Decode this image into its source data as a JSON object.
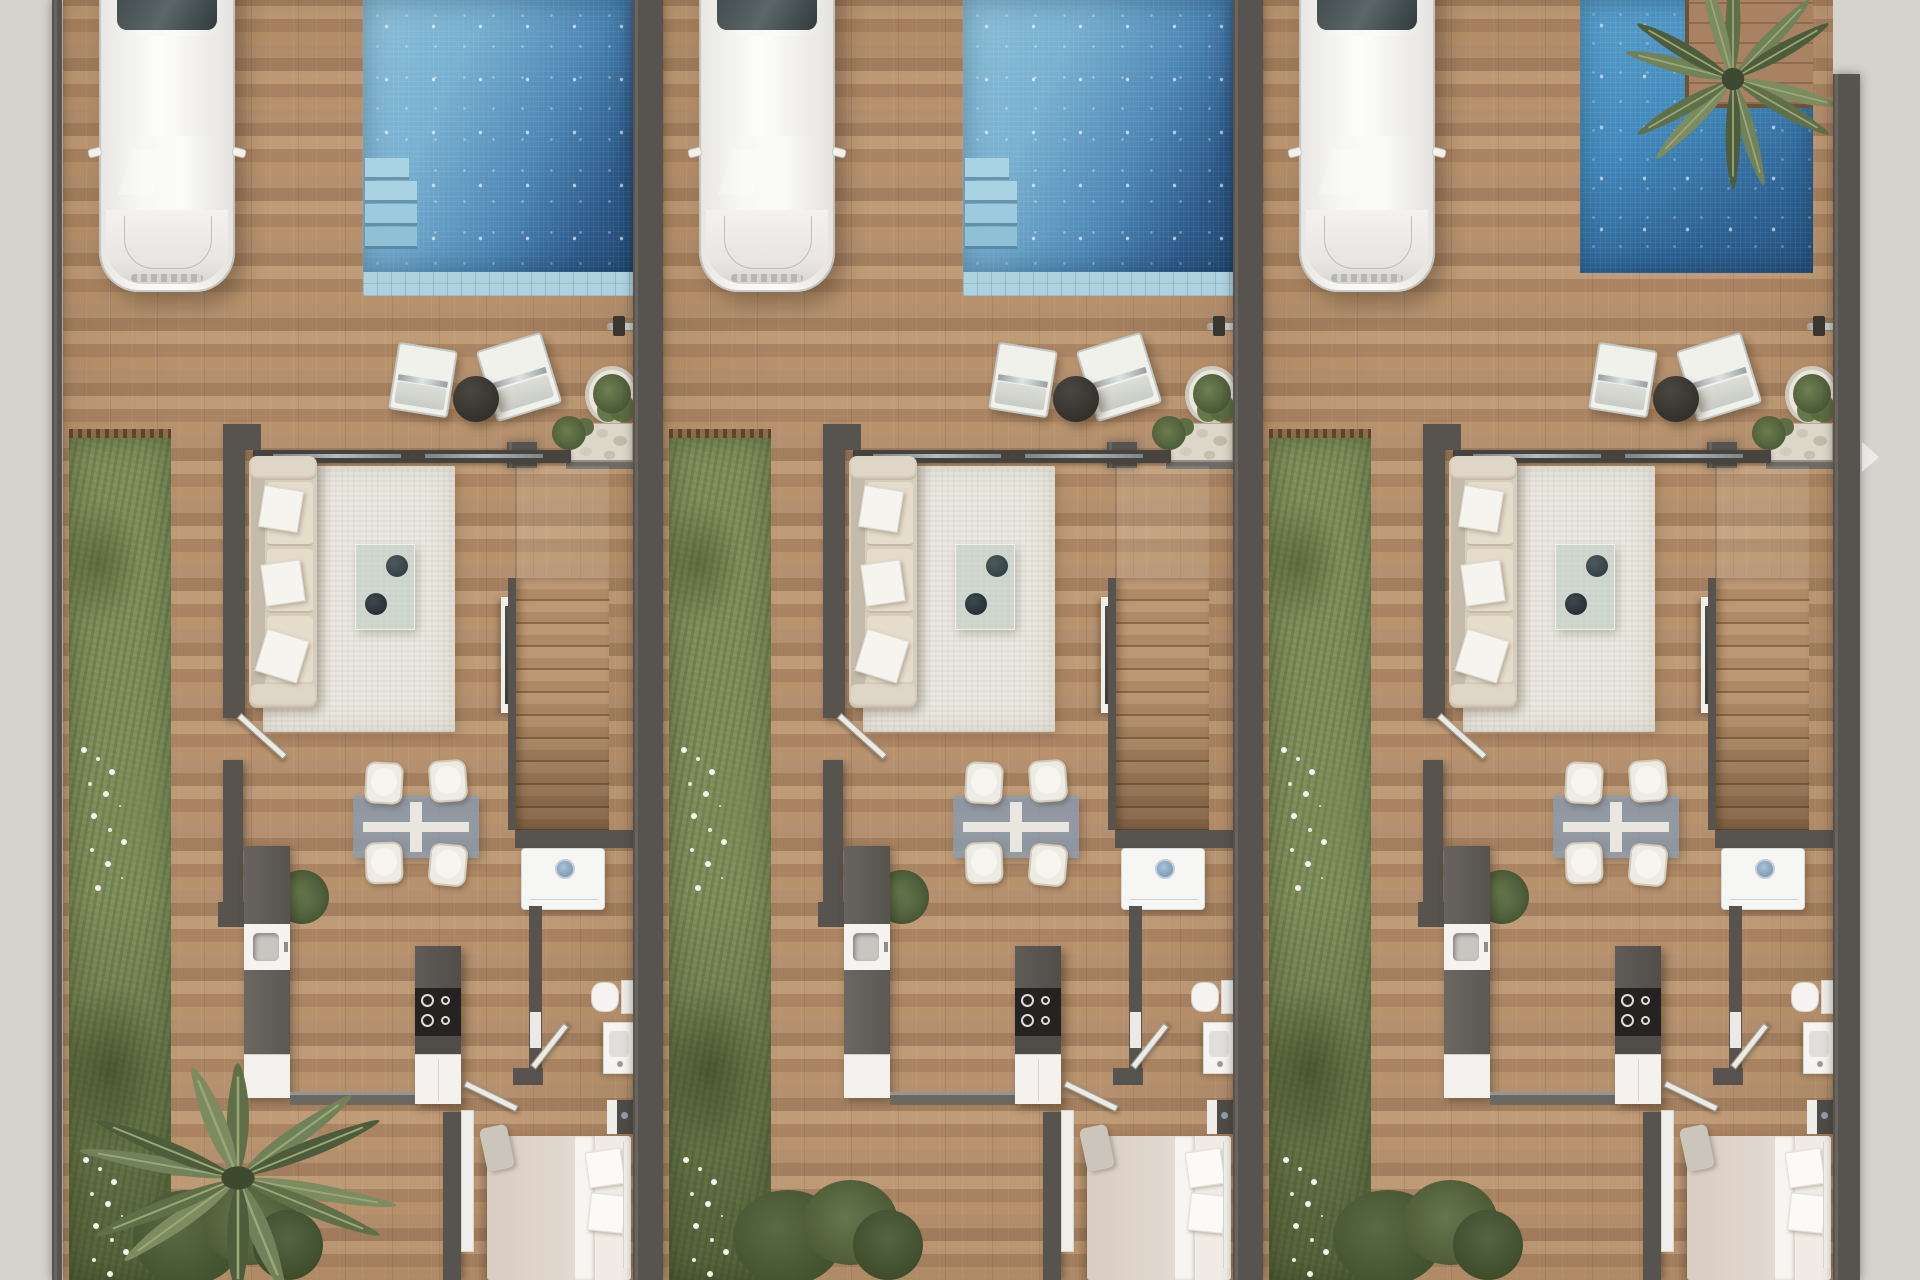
{
  "scene": {
    "description": "Aerial top-down 3D architectural render of three identical attached villas, each with driveway, parked white car, private swimming pool, outdoor lounge terrace, lawn strip, open-plan living-dining-kitchen, staircase, bathroom and double bedroom",
    "units_count": 3,
    "view": "ground floor plan, bird's eye",
    "next_arrow_visible": true
  },
  "colors": {
    "bg": "#d6d2ce",
    "wall": "#57534e",
    "wood": "#b28c6a",
    "grass": "#7e8e5c",
    "pool_light": "#8ec1d9",
    "pool_deep": "#234a72",
    "pool_coping": "#aed2df",
    "rug": "#eae8e0",
    "sofa": "#d7cdbd",
    "white_furniture": "#f2f1ed",
    "counter_dark": "#5f5c57",
    "cooktop": "#242322",
    "glass_table": "#8a9baf",
    "palm_green": "#5f7048",
    "arrow": "#ffffff"
  },
  "units": [
    {
      "id": "unit-1",
      "pool_variant": "large-with-steps",
      "garden_feature": "palm-tree",
      "features": {
        "car": 1,
        "pool_steps": 4,
        "lounge_chairs": 2,
        "terrace_side_table": 1,
        "plant_pots": 2,
        "sofa_pillows": 3,
        "coffee_table_vases": 2,
        "dining_chairs": 4,
        "cooktop_burners": 4,
        "bed_pillows": 2,
        "staircase": 1,
        "washing_machine": 1,
        "toilet": 1,
        "vanity": 1,
        "tv_panel": 1
      }
    },
    {
      "id": "unit-2",
      "pool_variant": "large-with-steps",
      "garden_feature": "shrubs",
      "features": {
        "car": 1,
        "pool_steps": 4,
        "lounge_chairs": 2,
        "terrace_side_table": 1,
        "plant_pots": 2,
        "sofa_pillows": 3,
        "coffee_table_vases": 2,
        "dining_chairs": 4,
        "cooktop_burners": 4,
        "bed_pillows": 2,
        "staircase": 1,
        "washing_machine": 1,
        "toilet": 1,
        "vanity": 1,
        "tv_panel": 1
      }
    },
    {
      "id": "unit-3",
      "pool_variant": "compact-with-palm-island",
      "garden_feature": "shrubs",
      "features": {
        "car": 1,
        "pool_palm_tree": 1,
        "lounge_chairs": 2,
        "terrace_side_table": 1,
        "plant_pots": 2,
        "sofa_pillows": 3,
        "coffee_table_vases": 2,
        "dining_chairs": 4,
        "cooktop_burners": 4,
        "bed_pillows": 2,
        "staircase": 1,
        "washing_machine": 1,
        "toilet": 1,
        "vanity": 1,
        "tv_panel": 1
      }
    }
  ]
}
